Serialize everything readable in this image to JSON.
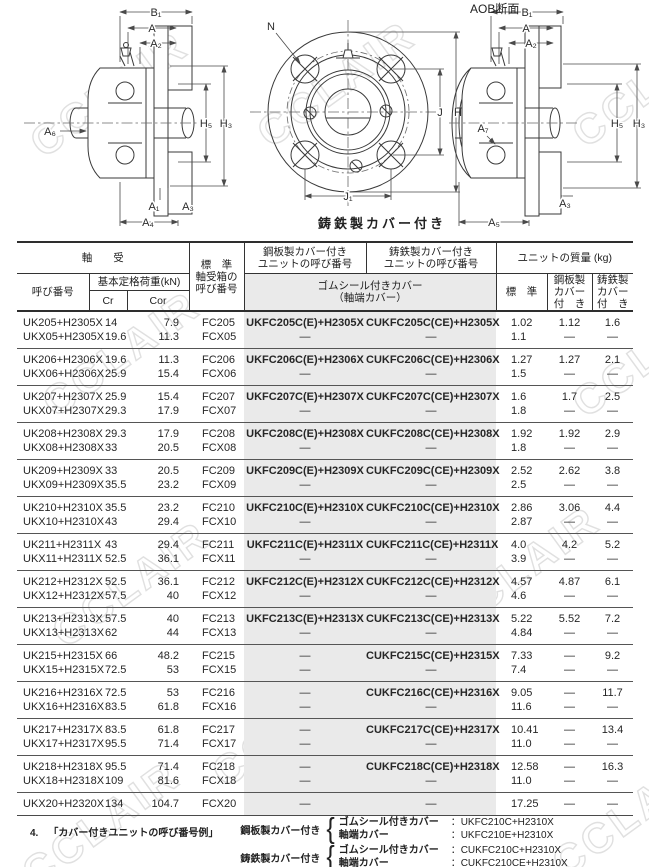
{
  "watermark": {
    "text": "CCLAIR"
  },
  "diagrams": {
    "left": {
      "labels": {
        "b1": "B₁",
        "a": "A",
        "a2": "A₂",
        "h5": "H₅",
        "h3": "H₃",
        "a6": "A₆",
        "a1": "A₁",
        "a3": "A₃",
        "a4": "A₄"
      }
    },
    "front": {
      "labels": {
        "n": "N",
        "j": "J",
        "h": "H",
        "j1": "J₁"
      },
      "caption": "鋳鉄製カバー付き"
    },
    "right": {
      "title": "AOB断面",
      "labels": {
        "b1": "B₁",
        "a": "A",
        "a2": "A₂",
        "h5": "H₅",
        "h3": "H₃",
        "a7": "A₇",
        "a3": "A₃",
        "a5": "A₅"
      }
    }
  },
  "table": {
    "header": {
      "bearing_group": "軸　　受",
      "part_no": "呼び番号",
      "load_rating": "基本定格荷重(kN)",
      "cr": "Cr",
      "cor": "Cor",
      "housing": "標　準\n軸受箱の\n呼び番号",
      "steel_cover_unit": "鋼板製カバー付き\nユニットの呼び番号",
      "cast_cover_unit": "鋳鉄製カバー付き\nユニットの呼び番号",
      "rubber_seal": "ゴムシール付きカバー\n（軸端カバー）",
      "mass_group": "ユニットの質量 (kg)",
      "mass_std": "標　準",
      "mass_steel": "鋼板製\nカバー\n付　き",
      "mass_cast": "鋳鉄製\nカバー\n付　き"
    },
    "groups": [
      {
        "rows": [
          [
            "UK205+H2305X",
            "14",
            "7.9",
            "FC205",
            "UKFC205C(E)+H2305X",
            "CUKFC205C(CE)+H2305X",
            "1.02",
            "1.12",
            "1.6"
          ],
          [
            "UKX05+H2305X",
            "19.6",
            "11.3",
            "FCX05",
            "—",
            "—",
            "1.1",
            "—",
            "—"
          ]
        ]
      },
      {
        "rows": [
          [
            "UK206+H2306X",
            "19.6",
            "11.3",
            "FC206",
            "UKFC206C(E)+H2306X",
            "CUKFC206C(CE)+H2306X",
            "1.27",
            "1.27",
            "2.1"
          ],
          [
            "UKX06+H2306X",
            "25.9",
            "15.4",
            "FCX06",
            "—",
            "—",
            "1.5",
            "—",
            "—"
          ]
        ]
      },
      {
        "rows": [
          [
            "UK207+H2307X",
            "25.9",
            "15.4",
            "FC207",
            "UKFC207C(E)+H2307X",
            "CUKFC207C(CE)+H2307X",
            "1.6",
            "1.7",
            "2.5"
          ],
          [
            "UKX07+H2307X",
            "29.3",
            "17.9",
            "FCX07",
            "—",
            "—",
            "1.8",
            "—",
            "—"
          ]
        ]
      },
      {
        "rows": [
          [
            "UK208+H2308X",
            "29.3",
            "17.9",
            "FC208",
            "UKFC208C(E)+H2308X",
            "CUKFC208C(CE)+H2308X",
            "1.92",
            "1.92",
            "2.9"
          ],
          [
            "UKX08+H2308X",
            "33",
            "20.5",
            "FCX08",
            "—",
            "—",
            "1.8",
            "—",
            "—"
          ]
        ]
      },
      {
        "rows": [
          [
            "UK209+H2309X",
            "33",
            "20.5",
            "FC209",
            "UKFC209C(E)+H2309X",
            "CUKFC209C(CE)+H2309X",
            "2.52",
            "2.62",
            "3.8"
          ],
          [
            "UKX09+H2309X",
            "35.5",
            "23.2",
            "FCX09",
            "—",
            "—",
            "2.5",
            "—",
            "—"
          ]
        ]
      },
      {
        "rows": [
          [
            "UK210+H2310X",
            "35.5",
            "23.2",
            "FC210",
            "UKFC210C(E)+H2310X",
            "CUKFC210C(CE)+H2310X",
            "2.86",
            "3.06",
            "4.4"
          ],
          [
            "UKX10+H2310X",
            "43",
            "29.4",
            "FCX10",
            "—",
            "—",
            "2.87",
            "—",
            "—"
          ]
        ]
      },
      {
        "rows": [
          [
            "UK211+H2311X",
            "43",
            "29.4",
            "FC211",
            "UKFC211C(E)+H2311X",
            "CUKFC211C(CE)+H2311X",
            "4.0",
            "4.2",
            "5.2"
          ],
          [
            "UKX11+H2311X",
            "52.5",
            "36.1",
            "FCX11",
            "—",
            "—",
            "3.9",
            "—",
            "—"
          ]
        ]
      },
      {
        "rows": [
          [
            "UK212+H2312X",
            "52.5",
            "36.1",
            "FC212",
            "UKFC212C(E)+H2312X",
            "CUKFC212C(CE)+H2312X",
            "4.57",
            "4.87",
            "6.1"
          ],
          [
            "UKX12+H2312X",
            "57.5",
            "40",
            "FCX12",
            "—",
            "—",
            "4.6",
            "—",
            "—"
          ]
        ]
      },
      {
        "rows": [
          [
            "UK213+H2313X",
            "57.5",
            "40",
            "FC213",
            "UKFC213C(E)+H2313X",
            "CUKFC213C(CE)+H2313X",
            "5.22",
            "5.52",
            "7.2"
          ],
          [
            "UKX13+H2313X",
            "62",
            "44",
            "FCX13",
            "—",
            "—",
            "4.84",
            "—",
            "—"
          ]
        ]
      },
      {
        "rows": [
          [
            "UK215+H2315X",
            "66",
            "48.2",
            "FC215",
            "—",
            "CUKFC215C(CE)+H2315X",
            "7.33",
            "—",
            "9.2"
          ],
          [
            "UKX15+H2315X",
            "72.5",
            "53",
            "FCX15",
            "—",
            "—",
            "7.4",
            "—",
            "—"
          ]
        ]
      },
      {
        "rows": [
          [
            "UK216+H2316X",
            "72.5",
            "53",
            "FC216",
            "—",
            "CUKFC216C(CE)+H2316X",
            "9.05",
            "—",
            "11.7"
          ],
          [
            "UKX16+H2316X",
            "83.5",
            "61.8",
            "FCX16",
            "—",
            "—",
            "11.6",
            "—",
            "—"
          ]
        ]
      },
      {
        "rows": [
          [
            "UK217+H2317X",
            "83.5",
            "61.8",
            "FC217",
            "—",
            "CUKFC217C(CE)+H2317X",
            "10.41",
            "—",
            "13.4"
          ],
          [
            "UKX17+H2317X",
            "95.5",
            "71.4",
            "FCX17",
            "—",
            "—",
            "11.0",
            "—",
            "—"
          ]
        ]
      },
      {
        "rows": [
          [
            "UK218+H2318X",
            "95.5",
            "71.4",
            "FC218",
            "—",
            "CUKFC218C(CE)+H2318X",
            "12.58",
            "—",
            "16.3"
          ],
          [
            "UKX18+H2318X",
            "109",
            "81.6",
            "FCX18",
            "—",
            "—",
            "11.0",
            "—",
            "—"
          ]
        ]
      },
      {
        "rows": [
          [
            "UKX20+H2320X",
            "134",
            "104.7",
            "FCX20",
            "—",
            "—",
            "17.25",
            "—",
            "—"
          ]
        ]
      }
    ]
  },
  "footnote": {
    "number": "4.",
    "title": "「カバー付きユニットの呼び番号例」",
    "entries": [
      {
        "type": "鋼板製カバー付き",
        "items": [
          {
            "label": "ゴムシール付きカバー",
            "value": "：UKFC210C+H2310X"
          },
          {
            "label": "軸端カバー",
            "value": "：UKFC210E+H2310X"
          }
        ]
      },
      {
        "type": "鋳鉄製カバー付き",
        "items": [
          {
            "label": "ゴムシール付きカバー",
            "value": "：CUKFC210C+H2310X"
          },
          {
            "label": "軸端カバー",
            "value": "：CUKFC210CE+H2310X"
          }
        ]
      }
    ]
  }
}
